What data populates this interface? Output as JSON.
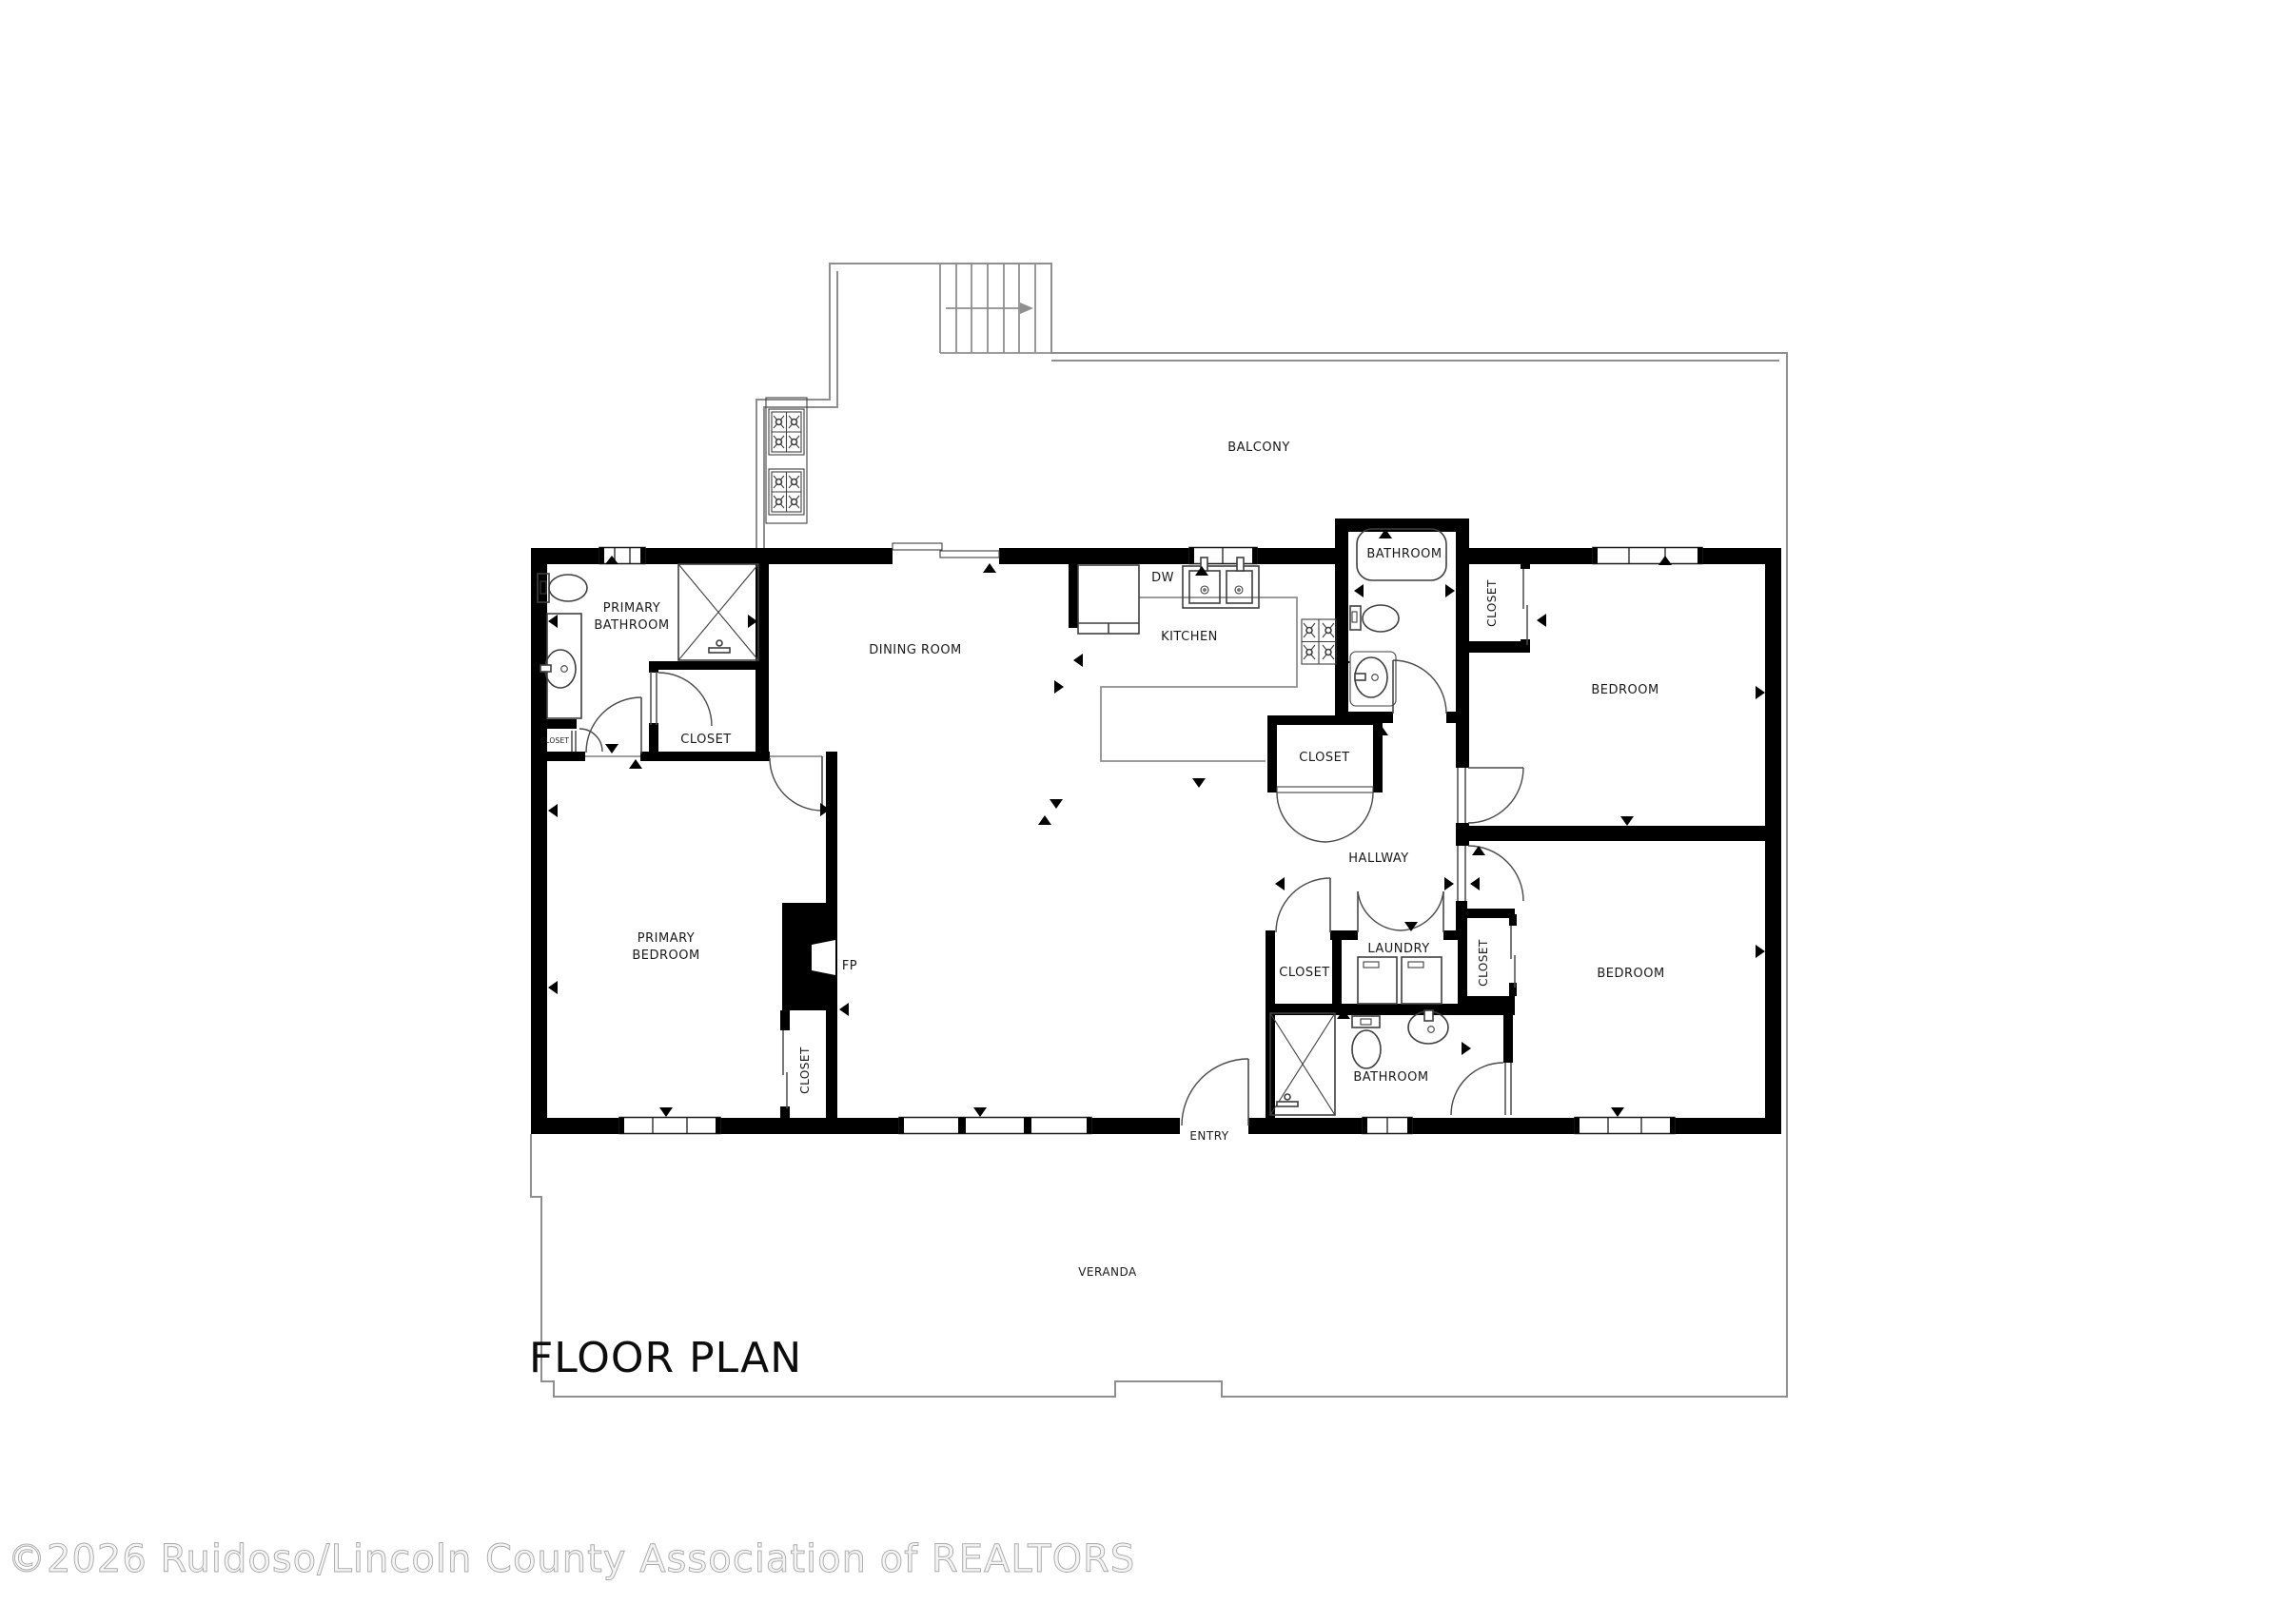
{
  "title": "FLOOR PLAN",
  "watermark": "©2026 Ruidoso/Lincoln County Association of REALTORS",
  "colors": {
    "walls": "#000000",
    "fixtures": "#3f3f3f",
    "outdoor_outline": "#8f8f8f",
    "watermark": "#a8a8a8"
  },
  "labels": {
    "balcony": "BALCONY",
    "primary_bathroom_line1": "PRIMARY",
    "primary_bathroom_line2": "BATHROOM",
    "closet_small": "CLOSET",
    "closet_primary": "CLOSET",
    "dining_room": "DINING ROOM",
    "kitchen": "KITCHEN",
    "dw": "DW",
    "bathroom_top": "BATHROOM",
    "closet_bedroom1": "CLOSET",
    "bedroom1": "BEDROOM",
    "primary_bedroom_line1": "PRIMARY",
    "primary_bedroom_line2": "BEDROOM",
    "fp": "FP",
    "closet_fireplace": "CLOSET",
    "hallway": "HALLWAY",
    "closet_hall": "CLOSET",
    "closet_laundry_left": "CLOSET",
    "laundry": "LAUNDRY",
    "closet_laundry_right": "CLOSET",
    "bathroom_bottom": "BATHROOM",
    "bedroom2": "BEDROOM",
    "entry": "ENTRY",
    "veranda": "VERANDA"
  }
}
